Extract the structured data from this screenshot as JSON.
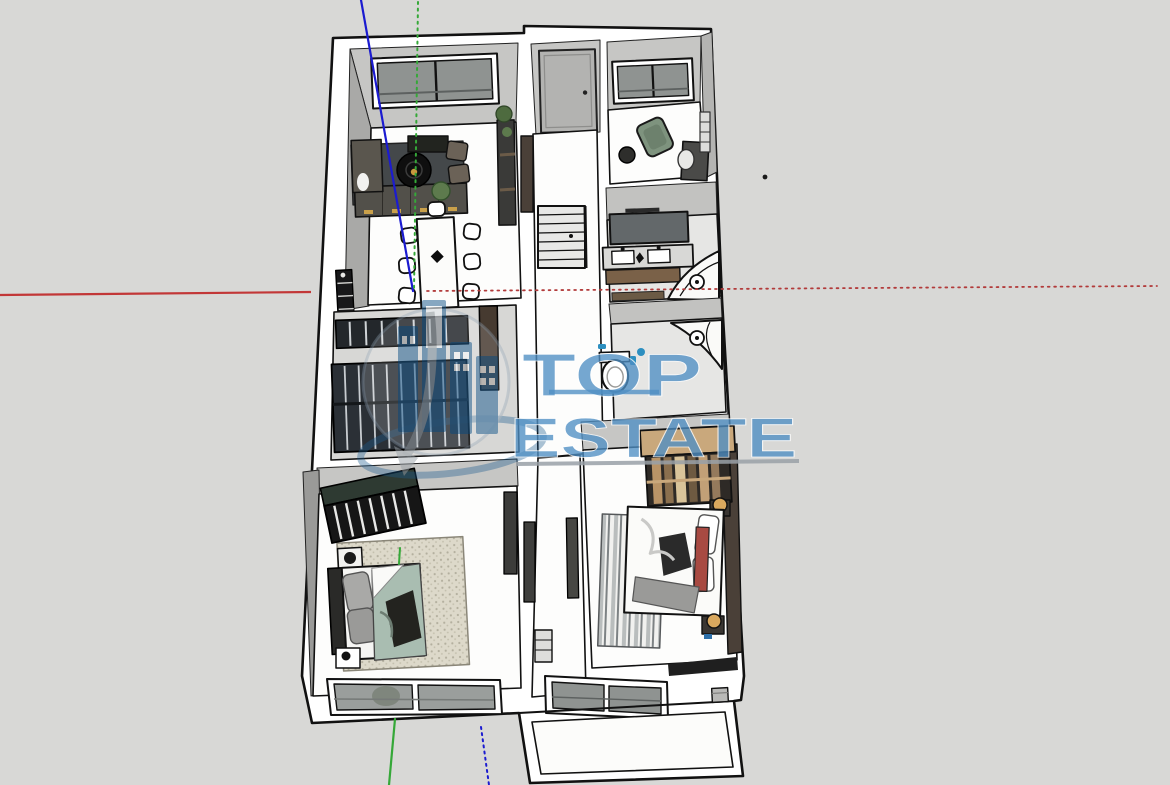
{
  "watermark": {
    "line1": "TOP",
    "line2": "ESTATE",
    "brand_blue": "#4f8fc4",
    "logo_blue": "#1d5c8f",
    "underline_gray": "#9aa1a8"
  },
  "axes": {
    "red": "#c23737",
    "red_dotted": "#b23b3b",
    "green": "#35a838",
    "blue": "#1b1bd0"
  },
  "palette": {
    "background": "#d8d8d6",
    "wall_white": "#ffffff",
    "wall_face_gray": "#c6c6c4",
    "floor_white": "#fdfdfc",
    "glass_gray": "#8f9391",
    "sofa_charcoal": "#52504a",
    "bed1_blanket_sage": "#a9bdb1",
    "bed2_runner_red": "#a84a42",
    "wardrobe2_tan": "#c9a87c",
    "armchair_green": "#7e937e",
    "bath_tile": "#e6e6e4"
  }
}
